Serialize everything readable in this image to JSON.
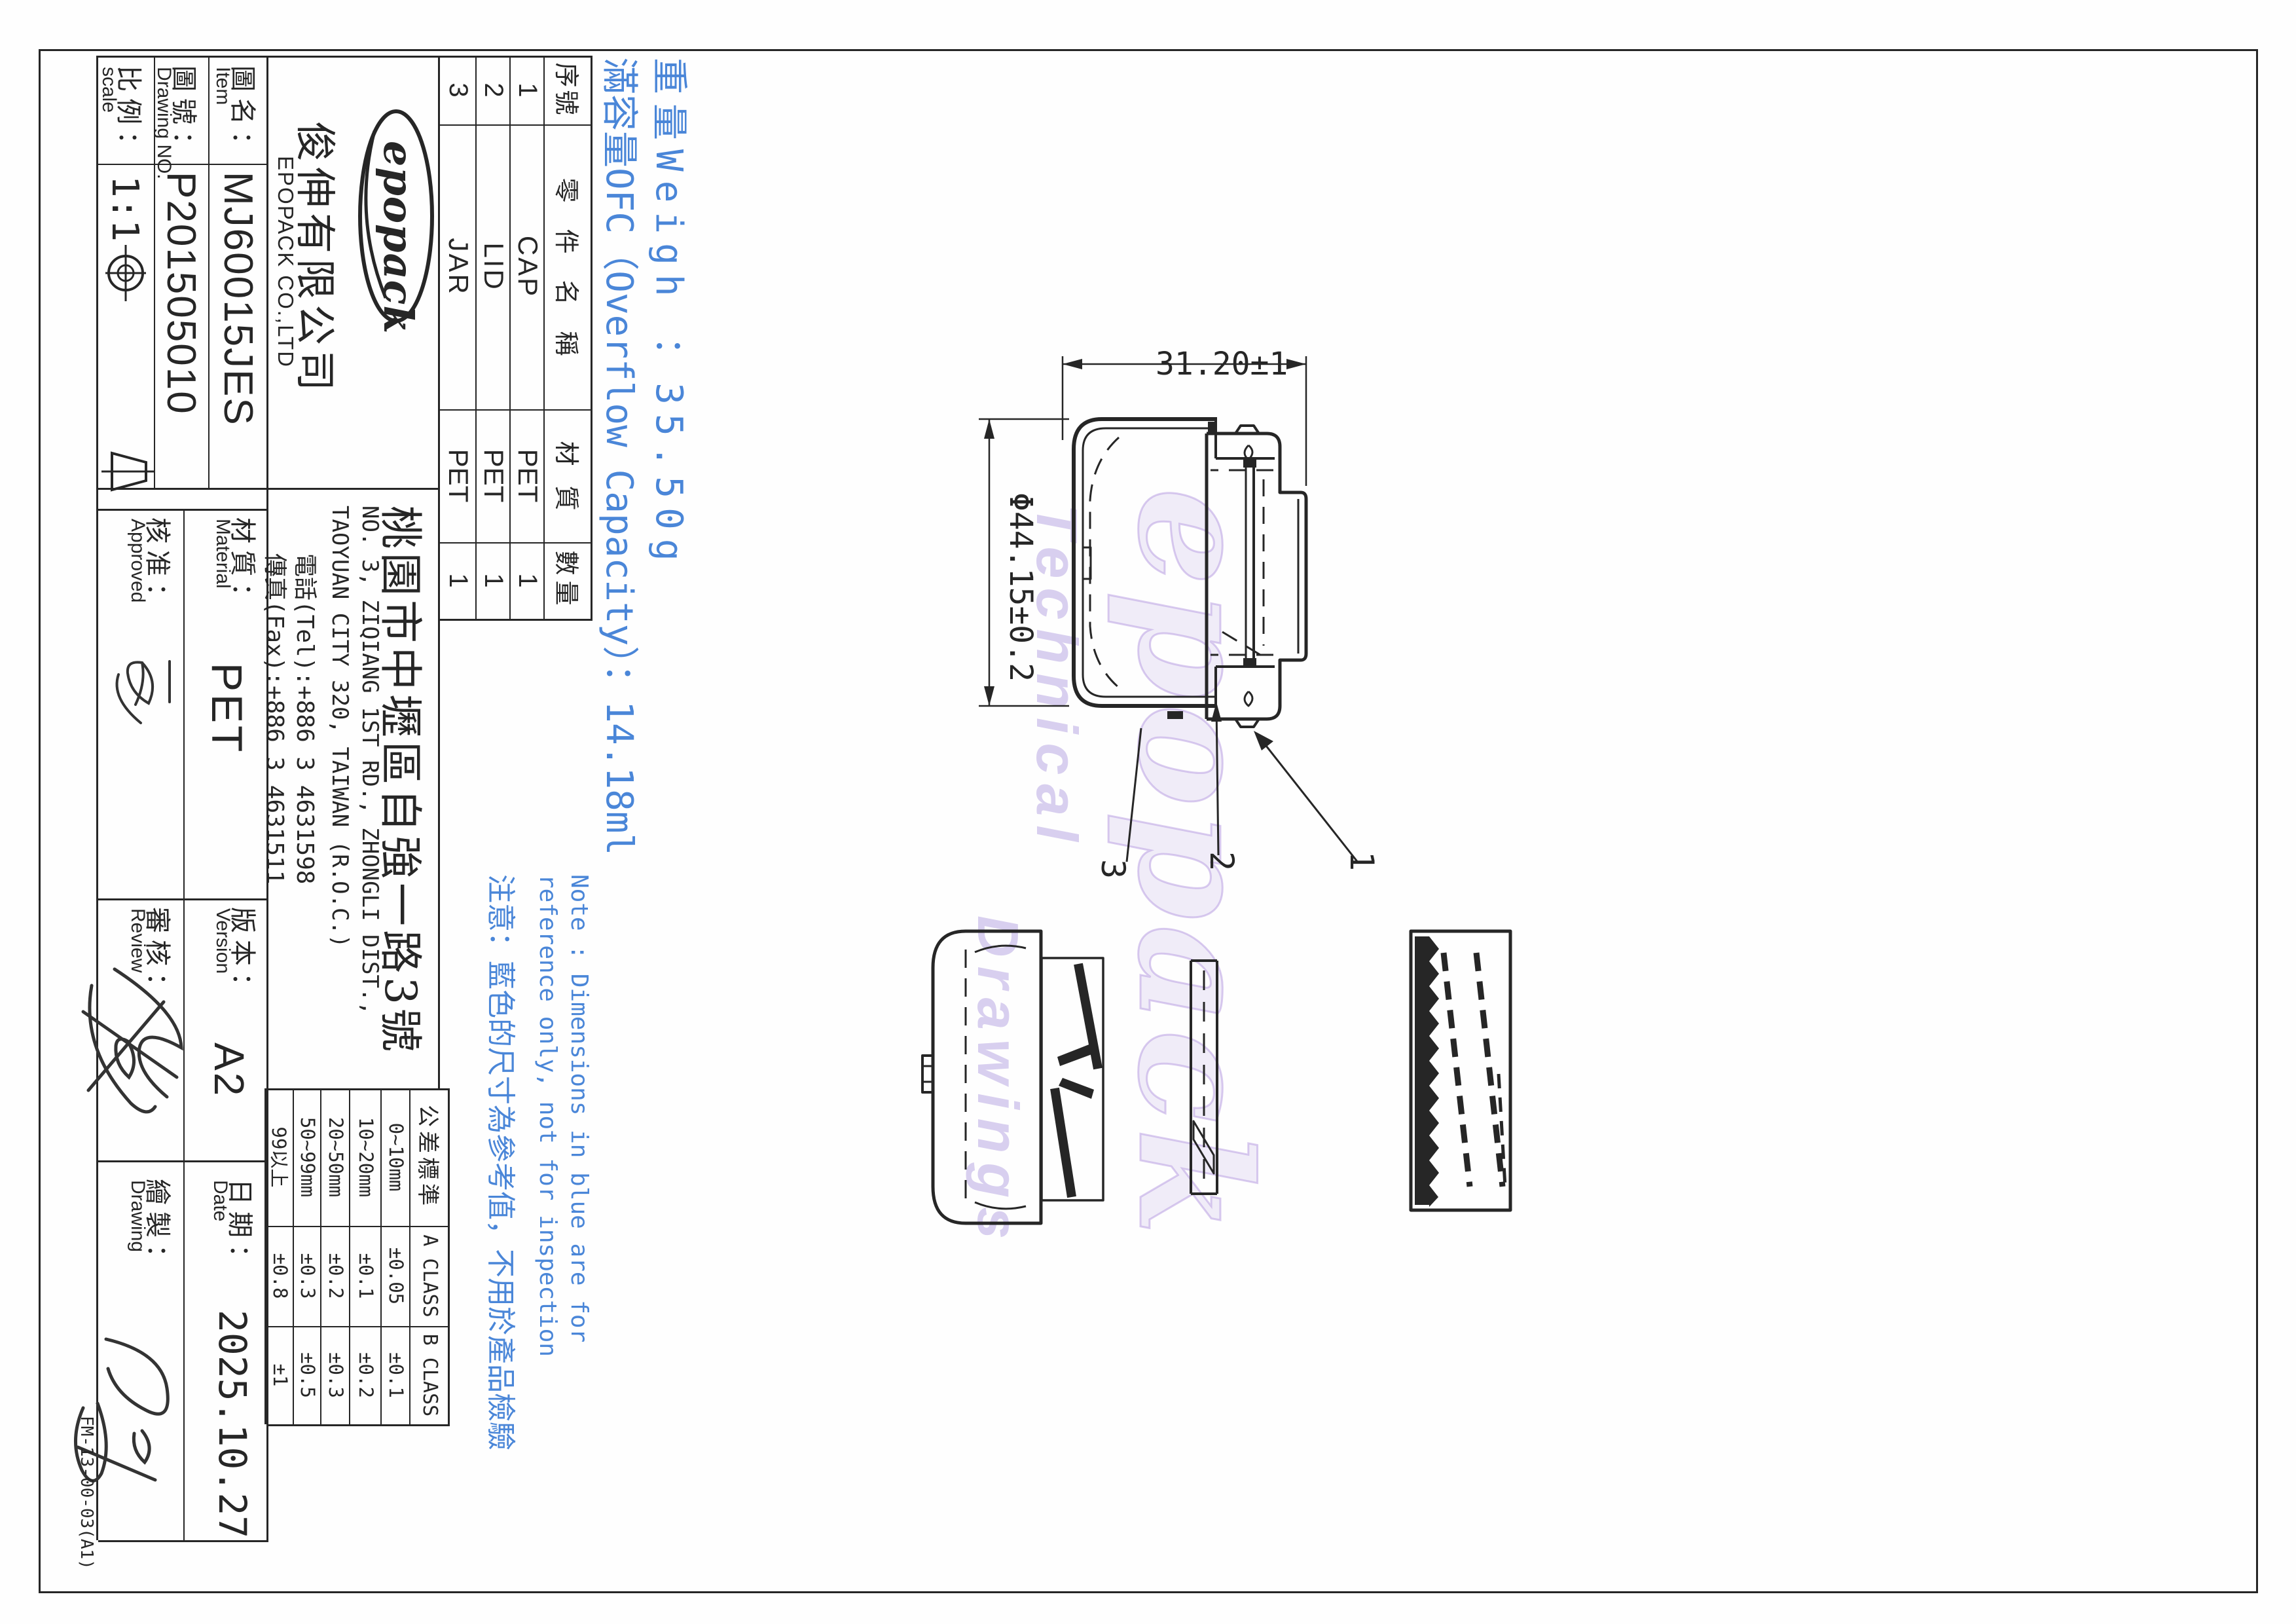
{
  "title_block": {
    "item": {
      "zh": "圖名：",
      "en": "Item",
      "value": "MJ60015JES"
    },
    "drawing_no": {
      "zh": "圖號：",
      "en": "Drawing NO.",
      "value": "P201505010"
    },
    "scale": {
      "zh": "比例：",
      "en": "scale",
      "value": "1:1"
    },
    "material": {
      "zh": "材質：",
      "en": "Material",
      "value": "PET"
    },
    "approved": {
      "zh": "核准：",
      "en": "Approved"
    },
    "version": {
      "zh": "版本：",
      "en": "Version",
      "value": "A2"
    },
    "review": {
      "zh": "審核：",
      "en": "Review"
    },
    "date": {
      "zh": "日期：",
      "en": "Date",
      "value": "2025.10.27"
    },
    "drawn": {
      "zh": "繪製：",
      "en": "Drawing"
    },
    "form_no": "FM-13-00-03(A1)"
  },
  "company": {
    "logo_text": "epopack",
    "name_zh": "俊伸有限公司",
    "name_en": "EPOPACK CO.,LTD",
    "address_zh": "桃園市中壢區自強一路3號",
    "address_en1": "NO. 3, ZIQIANG 1ST RD., ZHONGLI DIST.,",
    "address_en2": "TAOYUAN CITY 320, TAIWAN (R.O.C.)",
    "tel": "電話(Tel):+886 3 4631598",
    "fax": "傳真(Fax):+886 3 4631511"
  },
  "parts_table": {
    "headers": [
      "序號",
      "零件名稱",
      "材質",
      "數量"
    ],
    "rows": [
      [
        "1",
        "CAP",
        "PET",
        "1"
      ],
      [
        "2",
        "LID",
        "PET",
        "1"
      ],
      [
        "3",
        "JAR",
        "PET",
        "1"
      ]
    ]
  },
  "tolerance_table": {
    "headers": [
      "公差標準",
      "A CLASS",
      "B CLASS"
    ],
    "rows": [
      {
        "range": "0~10mm",
        "a": "±0.05",
        "b": "±0.1"
      },
      {
        "range": "10~20mm",
        "a": "±0.1",
        "b": "±0.2"
      },
      {
        "range": "20~50mm",
        "a": "±0.2",
        "b": "±0.3"
      },
      {
        "range": "50~99mm",
        "a": "±0.3",
        "b": "±0.5"
      },
      {
        "range": "99以上",
        "a": "±0.8",
        "b": "±1"
      }
    ]
  },
  "blue_notes": {
    "weight": "重量Weigh ：35.50g",
    "capacity": "滿容量OFC（Overflow Capacity）：14.18ml",
    "note1": "Note : Dimensions in blue are for",
    "note2": "reference only, not for inspection",
    "note3": "注意：藍色的尺寸為參考值，不用於產品檢驗"
  },
  "dimensions": {
    "height": "31.20±1",
    "diameter": "Φ44.15±0.2"
  },
  "callouts": [
    "1",
    "2",
    "3"
  ],
  "watermark": {
    "line1": "epopack",
    "line2": "Technical",
    "line3": "Drawings"
  },
  "colors": {
    "blue": "#4a86d8",
    "line": "#262626",
    "watermark": "#cfc0e8"
  }
}
